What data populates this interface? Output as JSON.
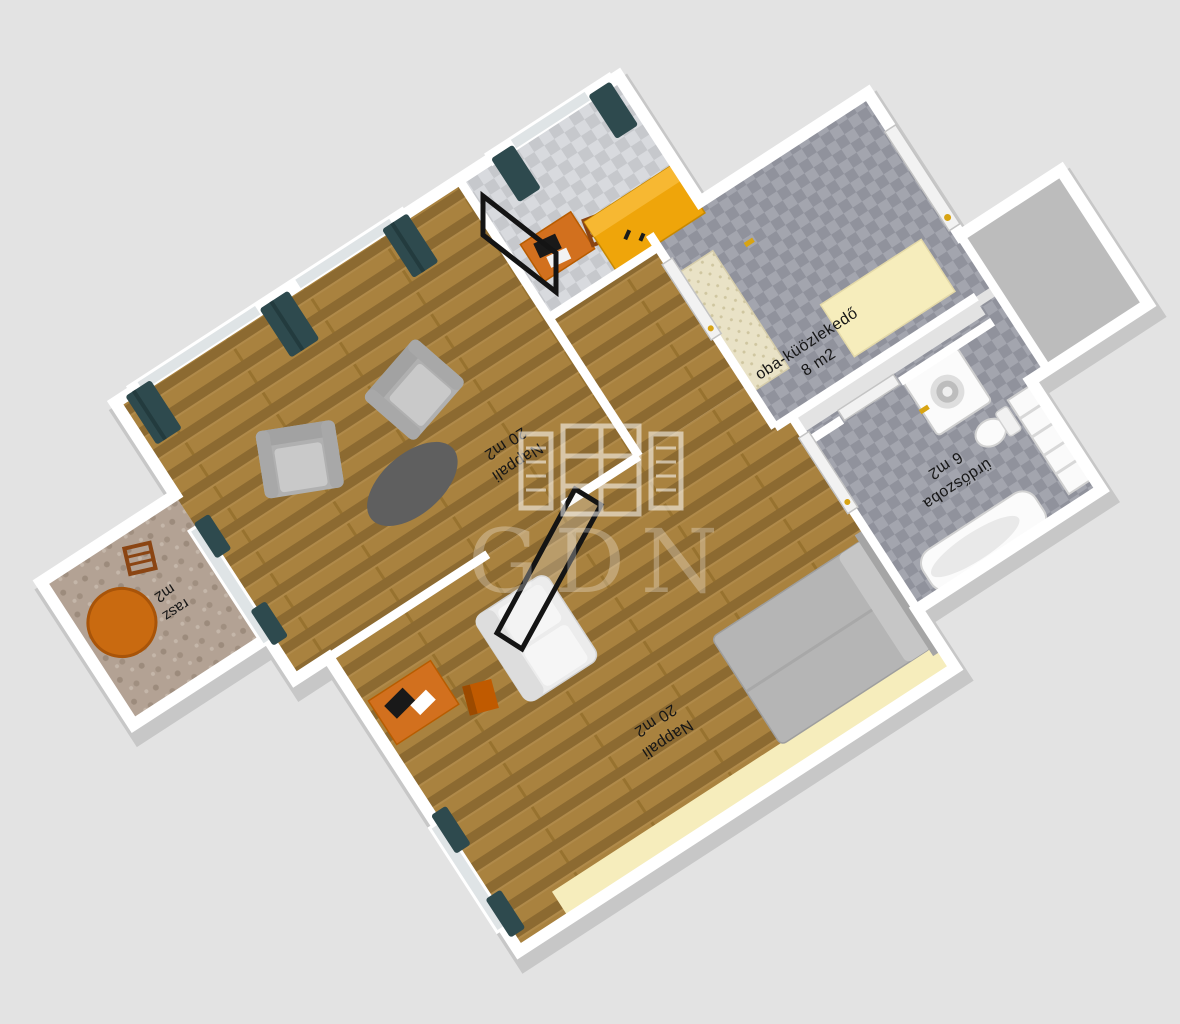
{
  "image": {
    "type": "3d-floorplan-render",
    "description": "Isometric 3D floor plan of an apartment with Hungarian room labels",
    "background_color": "#e3e3e3"
  },
  "watermark": {
    "text": "GDN",
    "icon": "open-window-logo"
  },
  "rooms": {
    "living_upper": {
      "name": "Nappali",
      "area": "20 m2"
    },
    "living_lower": {
      "name": "Nappali",
      "area": "20 m2"
    },
    "hallway": {
      "name": "oba-küözlekedő",
      "area": "8 m2"
    },
    "bathroom": {
      "name": "ürdőszoba",
      "area": "6 m2"
    },
    "terrace": {
      "name": "rasz",
      "area": "m2"
    }
  },
  "furniture": [
    "armchair",
    "armchair",
    "oval-coffee-table",
    "picture-frame",
    "sofa",
    "tv-frame",
    "desk-with-laptop",
    "desk-chair",
    "double-bed",
    "single-bed-yellow",
    "desk-upper",
    "wooden-chair",
    "hall-cabinet",
    "hall-wardrobe",
    "entry-door",
    "washing-machine",
    "toilet",
    "bathtub",
    "shelving-unit",
    "terrace-round-table",
    "terrace-chair",
    "curtains",
    "window",
    "sliding-door",
    "balcony-door"
  ],
  "colors": {
    "background": "#e3e3e3",
    "wall_top": "#ffffff",
    "wall_side": "#c7c7c7",
    "wood_floor": "#a9823f",
    "wood_floor_dark": "#8c6a31",
    "tile_dark": "#90929c",
    "tile_dark_light": "#a3a5ae",
    "tile_light": "#c6c8cc",
    "terrace_stone": "#b3a294",
    "curtain_teal": "#2e4a4e",
    "furniture_orange": "#d2701e",
    "bed_gold": "#efa50a",
    "cream": "#f6edbc",
    "beige_cabinet": "#e9e2c6",
    "furniture_gray": "#b7b7b7",
    "sofa_white": "#ececec",
    "bed_gray": "#b5b5b5",
    "frame_black": "#141414",
    "handle_gold": "#d8a413",
    "watermark": "rgba(255,255,255,0.5)"
  }
}
